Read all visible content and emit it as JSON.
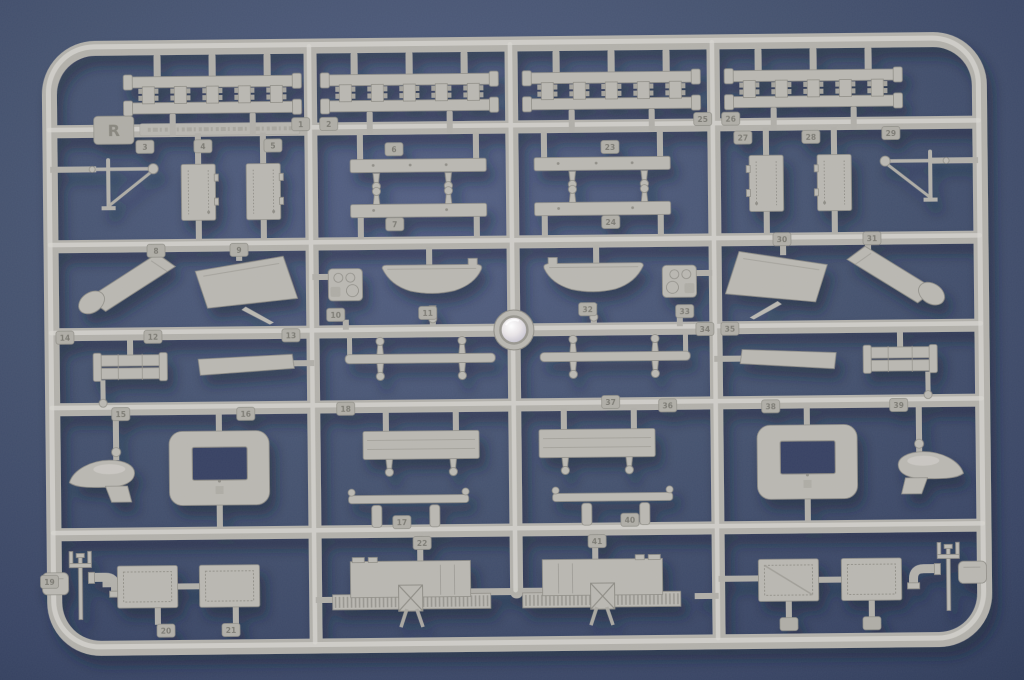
{
  "scene": {
    "type": "photograph",
    "subject": "Light grey injection-moulded plastic model kit parts sprue (runner frame) lying on a blue-grey studio background",
    "background_color": "#44516f",
    "plastic_color": "#b9b7b1",
    "shadow_color": "#151c33",
    "lighting": "soft top-left light, drop shadow toward lower right, glossy circular injection gate at sprue center"
  },
  "sprue": {
    "letter": "R",
    "layout": "rounded-rectangle outer frame with 3 internal vertical runners and 5 internal horizontal runners; parts arranged in 4 columns x 6 rows, left/right halves mirrored",
    "injection_gate": {
      "shape": "circle",
      "finish": "glossy pearl",
      "position": "center of sprue"
    },
    "part_tags": [
      "1",
      "2",
      "3",
      "4",
      "5",
      "6",
      "7",
      "8",
      "9",
      "10",
      "11",
      "12",
      "13",
      "14",
      "15",
      "16",
      "17",
      "18",
      "19",
      "20",
      "21",
      "22",
      "23",
      "24",
      "25",
      "26",
      "27",
      "28",
      "29",
      "30",
      "31",
      "32",
      "33",
      "34",
      "35",
      "36",
      "37",
      "38",
      "39",
      "40",
      "41"
    ],
    "parts_inventory": [
      {
        "name": "track-link / ladder assembly",
        "count": 4
      },
      {
        "name": "watertight door",
        "count": 4
      },
      {
        "name": "boat davit / mast bracket",
        "count": 2
      },
      {
        "name": "railed platform bar",
        "count": 4
      },
      {
        "name": "angled exhaust trunk with cap",
        "count": 2
      },
      {
        "name": "deckhouse side panel (trapezoid)",
        "count": 2
      },
      {
        "name": "ship's boat hull",
        "count": 2
      },
      {
        "name": "equipment housing block",
        "count": 2
      },
      {
        "name": "twin-tube cylinder assembly",
        "count": 2
      },
      {
        "name": "tapered deck plank",
        "count": 2
      },
      {
        "name": "long thin spar",
        "count": 2
      },
      {
        "name": "cowl ventilator (teardrop)",
        "count": 2
      },
      {
        "name": "skylight hatch frame with opening",
        "count": 2
      },
      {
        "name": "wide deck platform",
        "count": 2
      },
      {
        "name": "boom spreader with pulleys",
        "count": 2
      },
      {
        "name": "rectangular deck hatch",
        "count": 4
      },
      {
        "name": "ribbed hull bulkhead section",
        "count": 2
      },
      {
        "name": "elbow pipe",
        "count": 2
      },
      {
        "name": "twin bollard / trident post",
        "count": 2
      },
      {
        "name": "corner block",
        "count": 2
      },
      {
        "name": "ball-top stanchion pin",
        "count": 12
      }
    ]
  }
}
